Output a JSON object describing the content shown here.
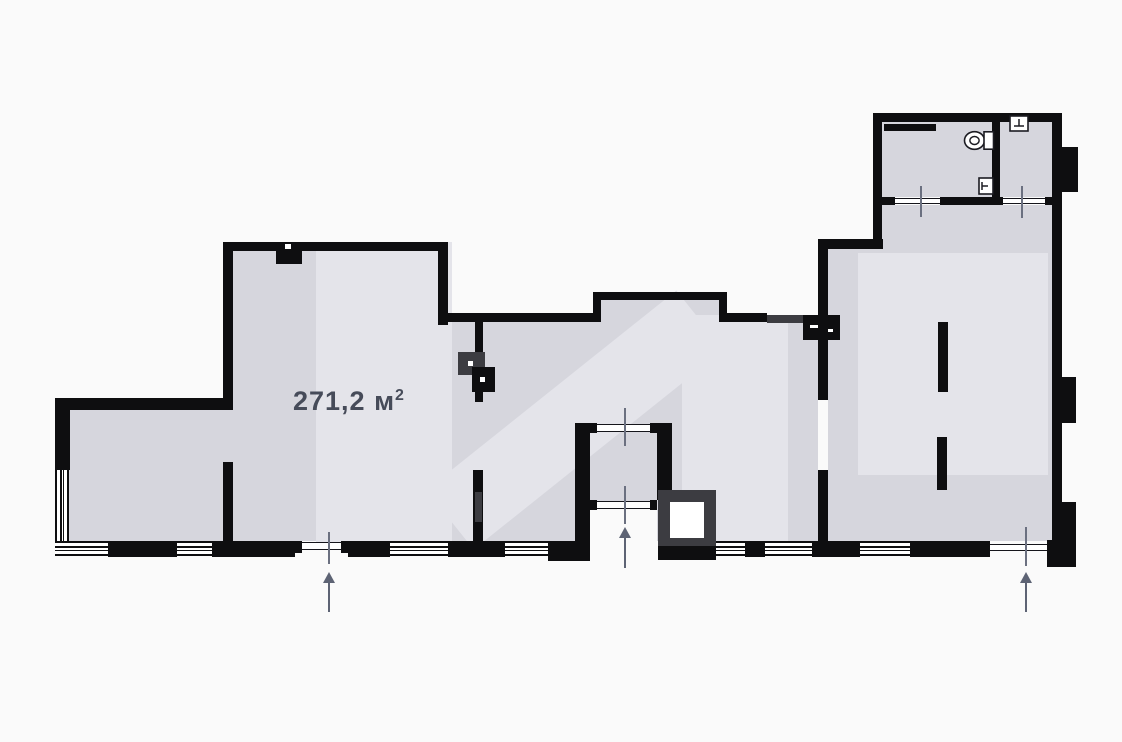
{
  "floor_plan": {
    "area_label": {
      "main": "271,2 м",
      "sup": "2",
      "full_text": "271,2 м²"
    },
    "entrances": [
      {
        "id": "left-entrance",
        "direction": "up"
      },
      {
        "id": "center-entrance",
        "direction": "up"
      },
      {
        "id": "right-entrance",
        "direction": "up"
      }
    ],
    "fixtures": [
      "toilet",
      "sink",
      "washbasin"
    ],
    "colors": {
      "background": "#fafafa",
      "floor_fill": "#d6d6dd",
      "watermark": "#e4e4ea",
      "walls": "#0e0e10",
      "wall_accent": "#3c3c41",
      "annotation_gray": "#5d6374",
      "area_text": "#464b59"
    }
  }
}
